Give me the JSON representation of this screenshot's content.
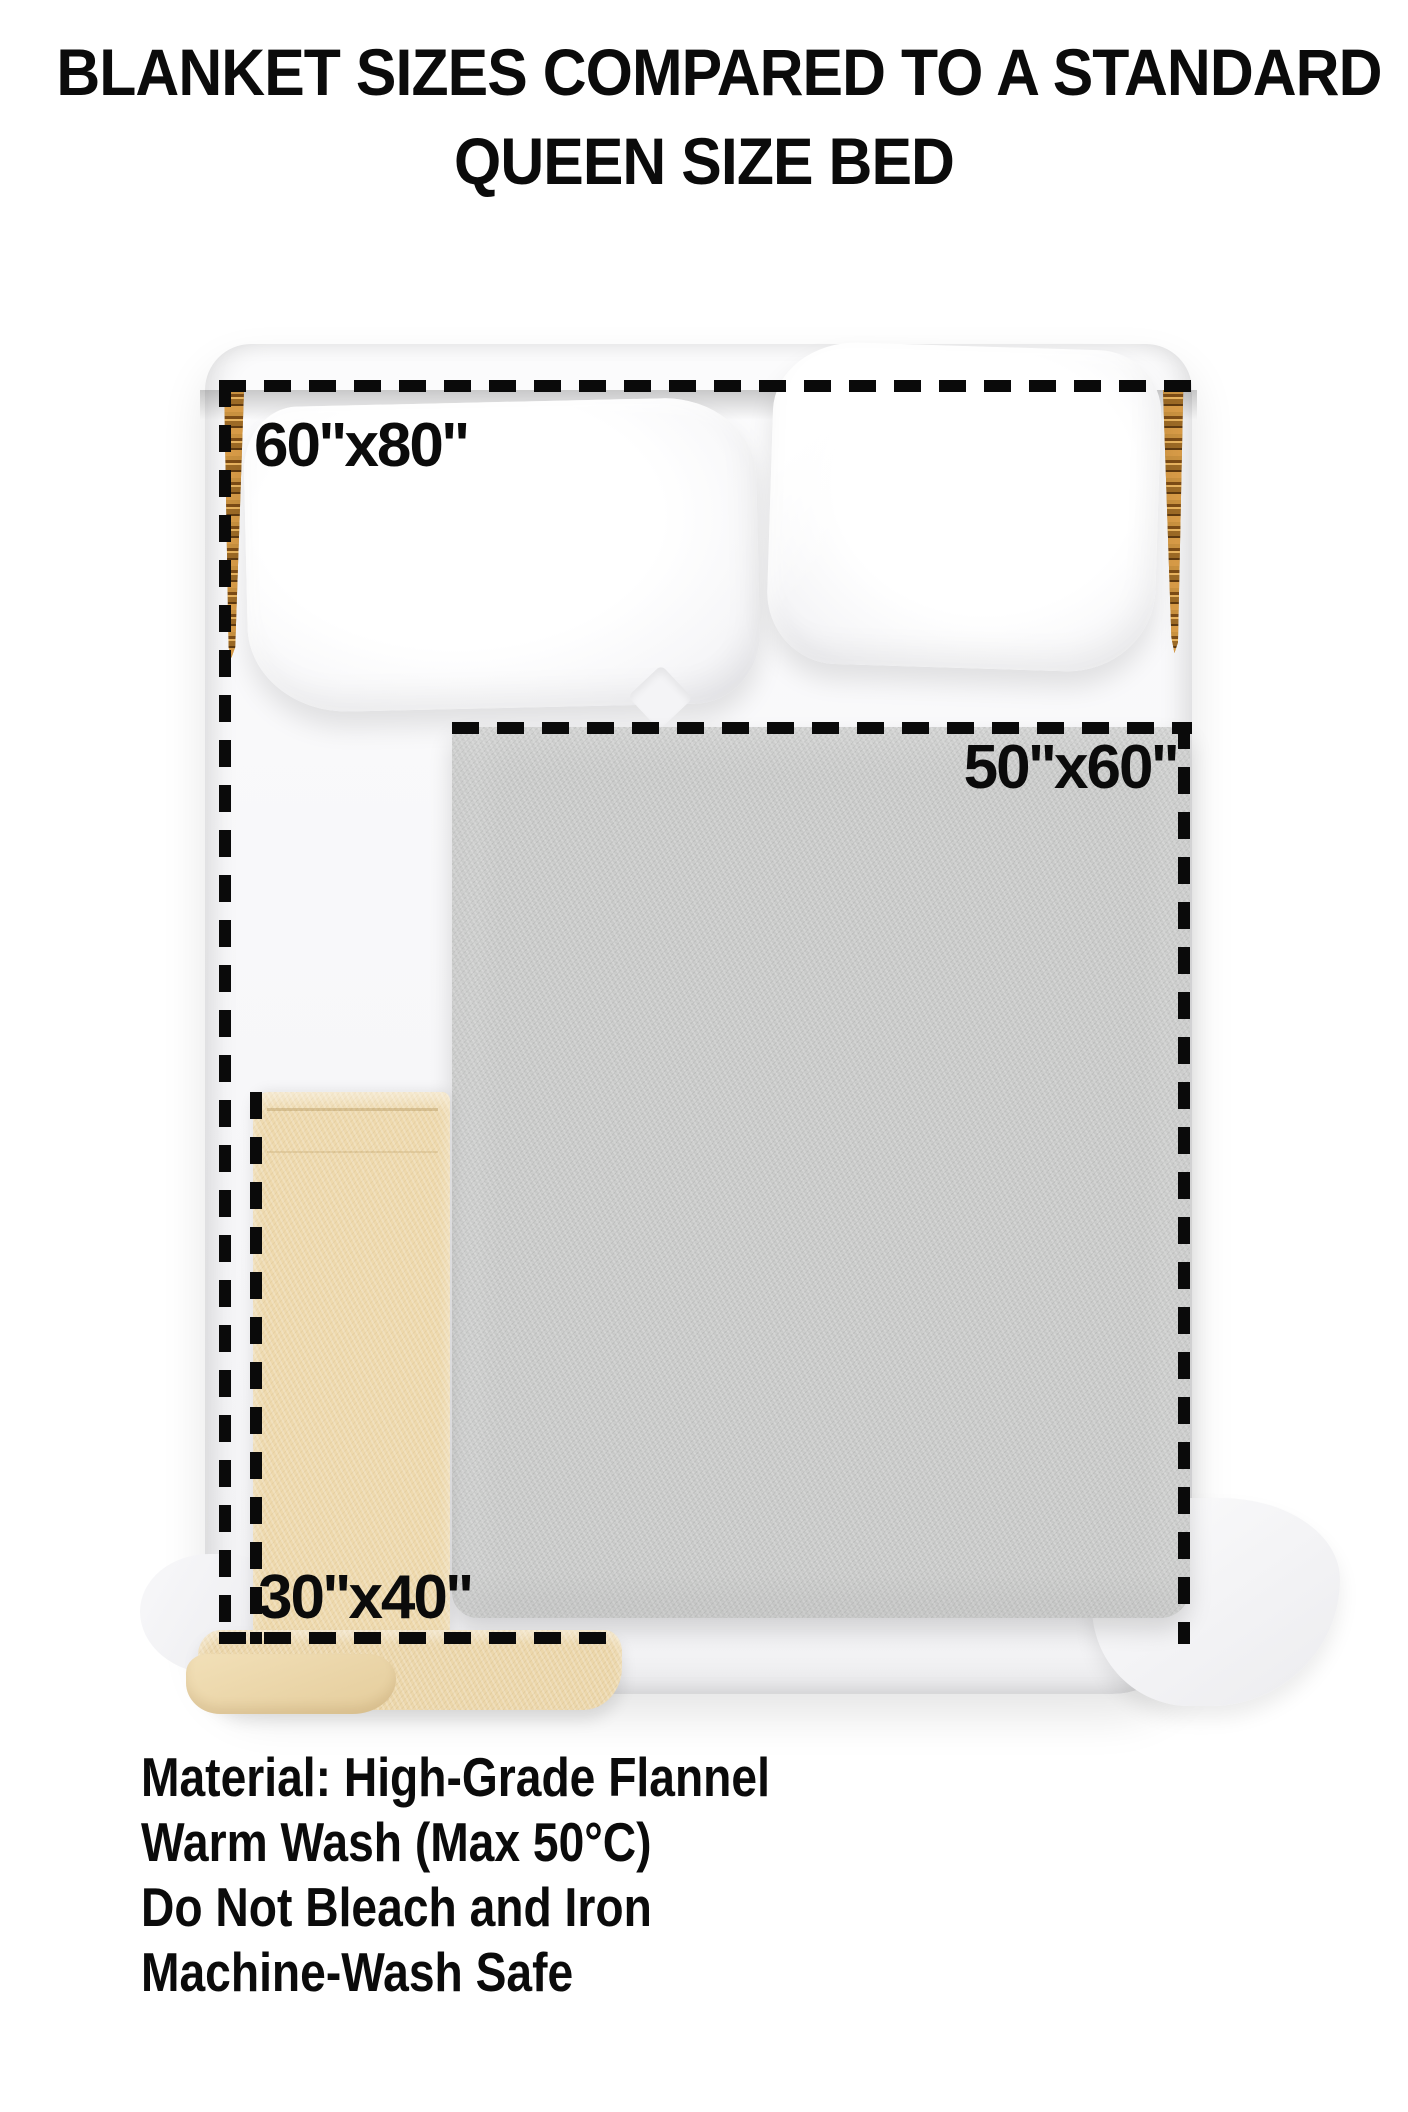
{
  "title": {
    "line1": "BLANKET SIZES COMPARED TO A STANDARD",
    "line2": "QUEEN SIZE BED"
  },
  "diagram": {
    "subject": "queen-size-bed-top-view",
    "bed_parts": [
      "wood-headboard",
      "left-side-rail",
      "right-side-rail",
      "mattress-with-white-sheet",
      "left-pillow",
      "right-pillow"
    ],
    "blankets": [
      {
        "id": "60x80",
        "label": "60''x80''",
        "shown_as": "dashed outline over the whole bed"
      },
      {
        "id": "50x60",
        "label": "50''x60''",
        "shown_as": "gray fleece blanket with dashed outline"
      },
      {
        "id": "30x40",
        "label": "30''x40''",
        "shown_as": "beige fleece blanket with dashed outline"
      }
    ]
  },
  "care": {
    "lines": [
      "Material: High-Grade Flannel",
      "Warm Wash (Max 50°C)",
      "Do Not Bleach and Iron",
      "Machine-Wash Safe"
    ]
  },
  "colors": {
    "dash": "#0a0a0a",
    "text": "#0b0b0b",
    "wood": "#a9752c",
    "gray-blanket": "#c8c9c8",
    "beige-blanket": "#eed9ad",
    "sheet": "#f7f7f9",
    "background": "#ffffff"
  }
}
